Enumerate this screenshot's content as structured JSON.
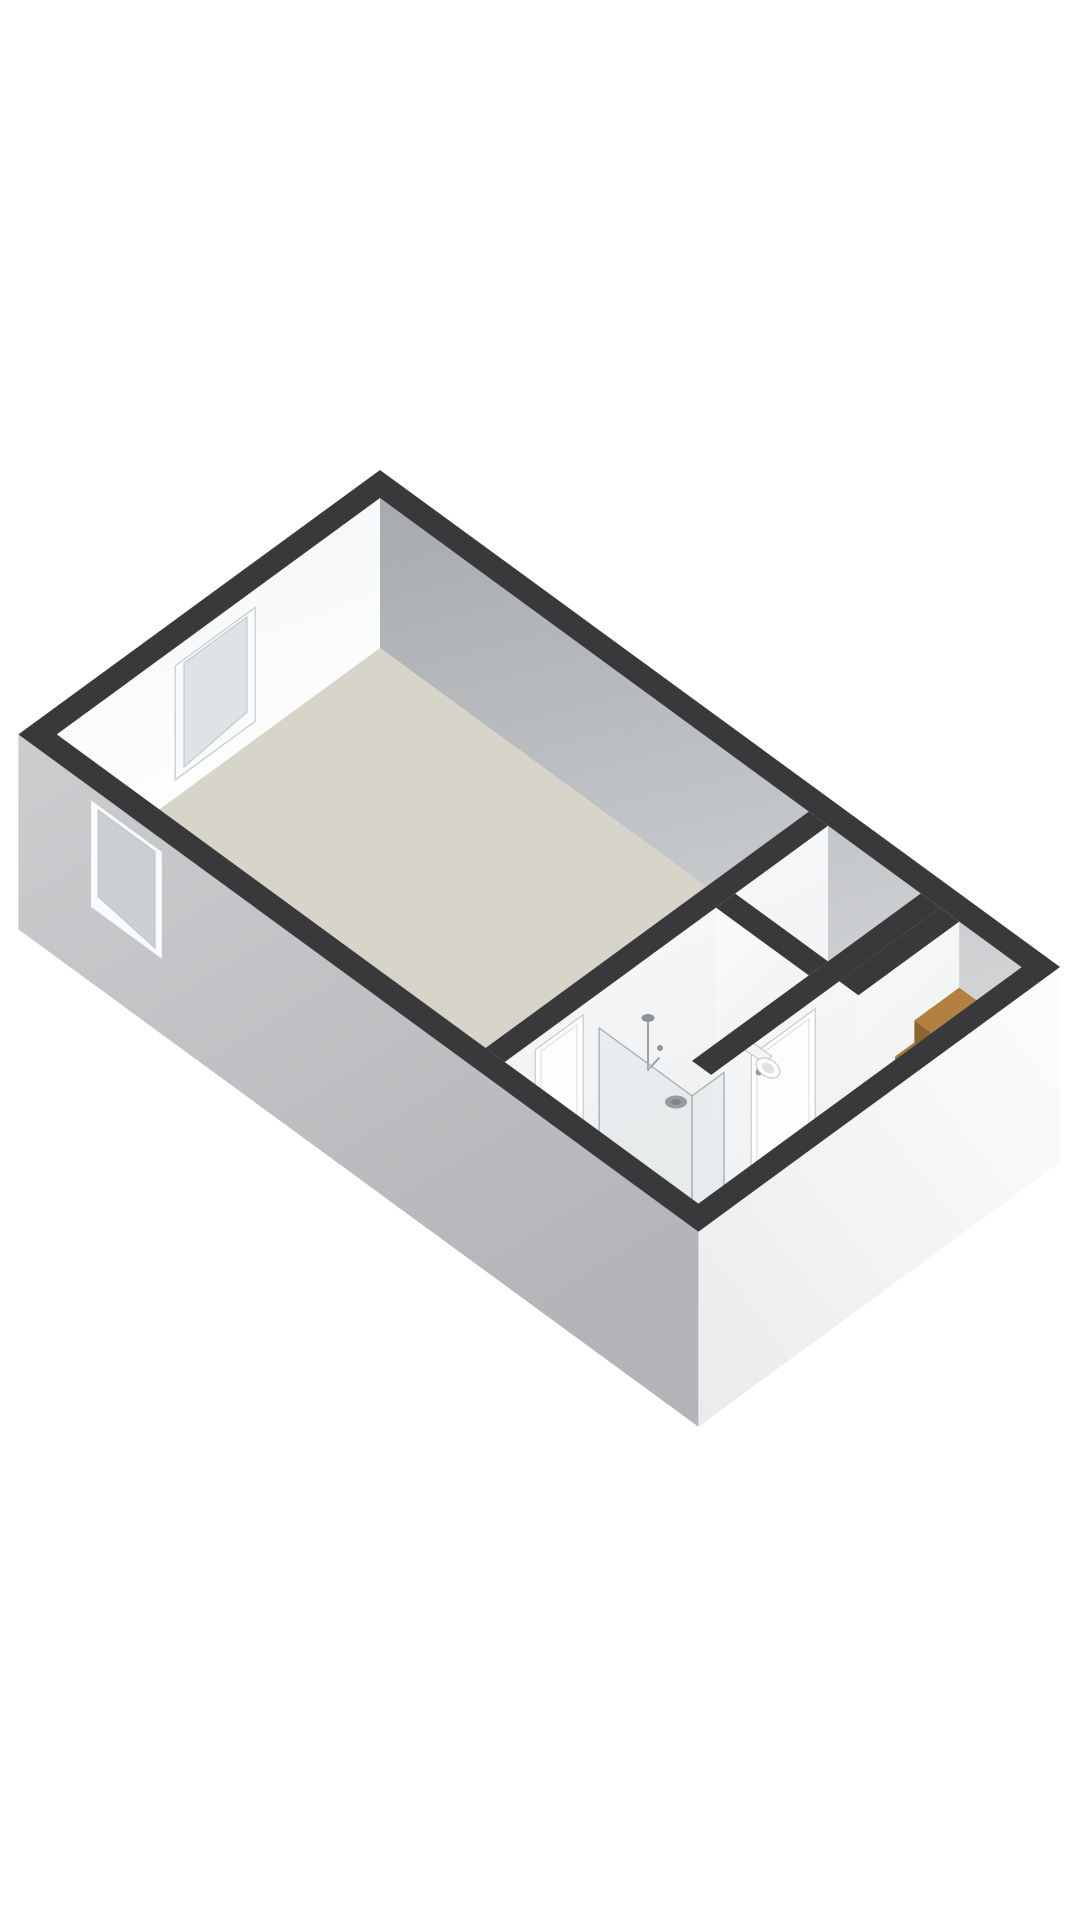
{
  "scene": {
    "kind": "3d-isometric-floorplan",
    "level": "apartment-floor",
    "rooms": [
      {
        "name": "living-room",
        "floor_finish": "beige"
      },
      {
        "name": "bathroom",
        "floor_finish": "white",
        "fixtures": [
          "walk-in-shower",
          "shower-drain",
          "glass-shower-screen",
          "toilet"
        ]
      },
      {
        "name": "hallway",
        "floor_finish": "beige",
        "fixtures": [
          "interior-door",
          "entry-steps"
        ]
      },
      {
        "name": "closet",
        "floor_finish": "light-gray"
      },
      {
        "name": "staircase",
        "fixtures": [
          "wood-landing",
          "wood-treads",
          "white-lower-steps"
        ]
      }
    ],
    "window_count": 2,
    "door_count": 2
  },
  "colors": {
    "background": "#ffffff",
    "wall_top": "#39393b",
    "wall_top_soft": "#434345",
    "ext_sw_light": "#cbcdcf",
    "ext_sw_dark": "#b2b4b7",
    "ext_se_light": "#fdfdfe",
    "ext_se_dark": "#e9ebec",
    "int_ne_dark": "#a8abae",
    "int_ne_light": "#d2d4d6",
    "int_nw_light": "#f4f6f7",
    "int_nw_white": "#ffffff",
    "face_white": "#fafbfc",
    "face_white_shade": "#edeff1",
    "floor_main": "#d7d4ca",
    "floor_hall": "#d9d6cc",
    "floor_bath": "#f1f2f1",
    "floor_closet": "#eceded",
    "wood_landing": "#b3813f",
    "wood_tread": "#aa783c",
    "wood_riser": "#8d6330",
    "step_white": "#f1f2f3",
    "step_white_riser": "#e0e2e4",
    "glass_fill": "rgba(205,218,224,0.28)",
    "window_frame": "#fafbfc",
    "window_glass_int": "#dfe3e5",
    "window_glass_ext": "#c9cfd2",
    "door_white": "#fdfdfe",
    "handle_gray": "#8f9396",
    "drain_gray": "#82868a",
    "drain_dark": "#5f6366",
    "toilet_white": "#fcfdfd",
    "toilet_tank": "#f3f4f5",
    "se_inner": "#d4d6d8"
  }
}
